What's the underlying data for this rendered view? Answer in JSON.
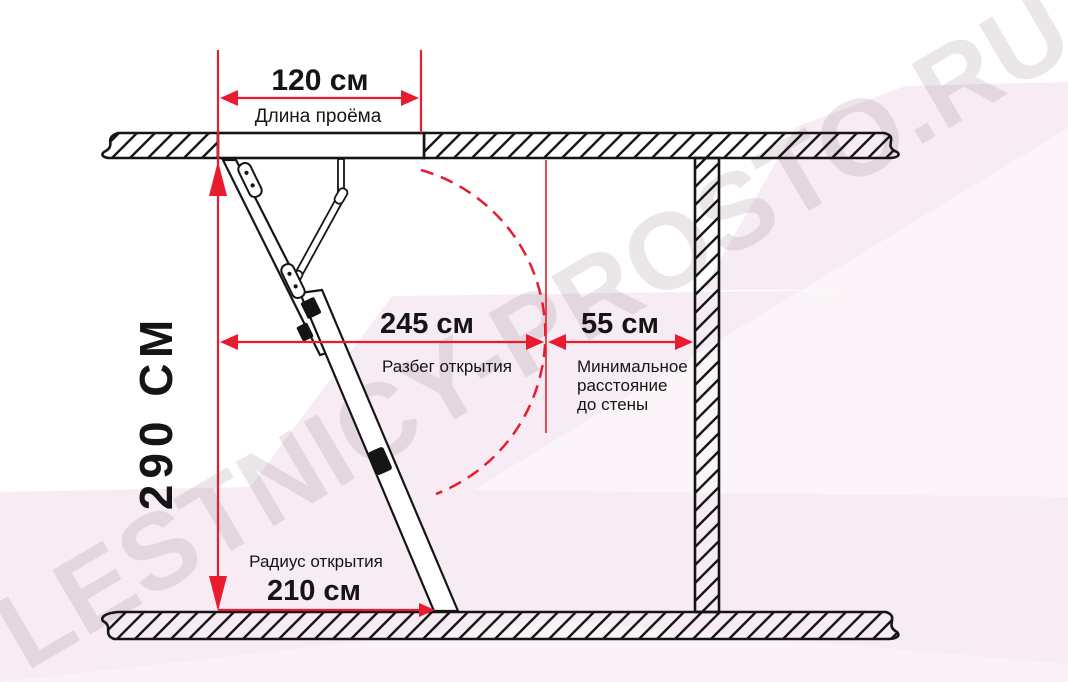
{
  "watermark": {
    "text": "LESTNICY-PROSTO.RU"
  },
  "dimensions": {
    "opening_length": {
      "value": "120 см",
      "label": "Длина проёма"
    },
    "ceiling_height": {
      "value": "290 СМ"
    },
    "opening_run": {
      "value": "245 см",
      "label": "Разбег открытия"
    },
    "min_wall_distance": {
      "value": "55 см",
      "label_lines": [
        "Минимальное",
        "расстояние",
        "до стены"
      ]
    },
    "opening_radius": {
      "value": "210 см",
      "label": "Радиус открытия"
    }
  },
  "colors": {
    "dimension_red": "#e81c2e",
    "line_black": "#151515",
    "background_pink": "#f7ecf3",
    "watermark_color": "#6b4a5e"
  }
}
